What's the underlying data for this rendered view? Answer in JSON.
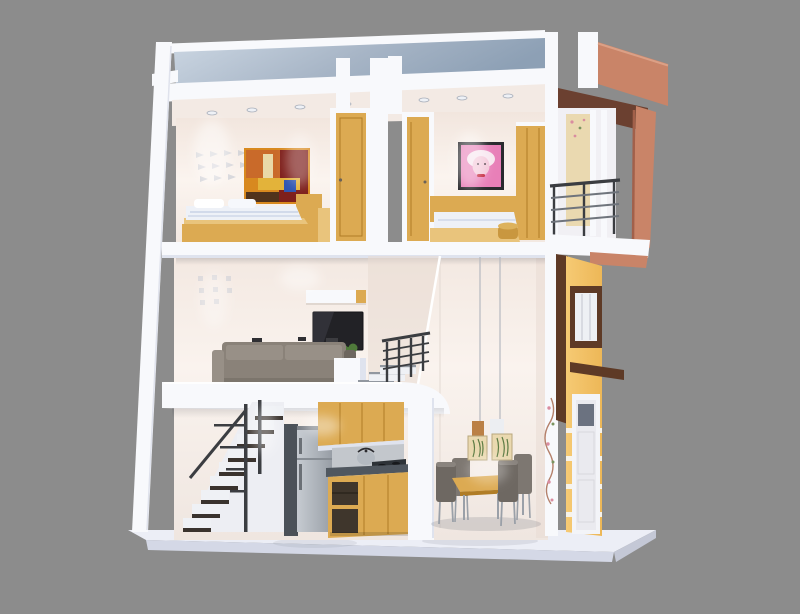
{
  "scene": {
    "type": "3d-architectural-cutaway-render",
    "description": "Dollhouse cross-section of a narrow three-level townhouse on a gray studio background",
    "background": "#8c8c8c"
  },
  "house": {
    "floors": [
      {
        "name": "roof-terrace",
        "items": [
          "white-parapet",
          "blue-gray-roof-deck",
          "terracotta-roof-box"
        ]
      },
      {
        "name": "upper-floor",
        "rooms": [
          {
            "name": "bedroom-left",
            "items": [
              "wall-decal",
              "abstract-painting",
              "wood-bed",
              "white-bedding",
              "wood-headboard",
              "wood-door"
            ]
          },
          {
            "name": "bedroom-right",
            "items": [
              "wood-door",
              "pop-art-portrait",
              "wood-bed",
              "gold-pouf",
              "wood-wardrobe"
            ]
          },
          {
            "name": "balcony",
            "items": [
              "cream-curtain-panel",
              "white-mullions",
              "metal-railing",
              "terracotta-frame"
            ]
          }
        ]
      },
      {
        "name": "mezzanine-floor",
        "rooms": [
          {
            "name": "living-room",
            "items": [
              "wall-decal",
              "wall-shelf",
              "wall-mounted-tv",
              "potted-plant",
              "white-side-table",
              "gray-sofa",
              "stair-railing",
              "steps-to-upper"
            ]
          }
        ]
      },
      {
        "name": "ground-floor",
        "rooms": [
          {
            "name": "staircase",
            "items": [
              "dark-tread-stairs",
              "metal-railing"
            ]
          },
          {
            "name": "kitchen",
            "items": [
              "refrigerator",
              "upper-wood-cabinets",
              "kettle",
              "cooktop",
              "dark-countertop",
              "lower-wood-cabinets"
            ]
          },
          {
            "name": "dining-area",
            "items": [
              "pendant-lamps-fern-shades",
              "wood-dining-table",
              "four-gray-chairs",
              "vine-wall-decor"
            ]
          },
          {
            "name": "street-facade",
            "items": [
              "yellow-wall",
              "brown-framed-window",
              "brown-sill",
              "white-entry-door",
              "white-grooves"
            ]
          }
        ]
      }
    ],
    "base": "white-display-plinth"
  },
  "colors": {
    "bg": "#8c8c8c",
    "slab": "#f8f9fc",
    "slabShade": "#dfe3ee",
    "slabDeep": "#c9cdda",
    "wall": "#f6ece5",
    "wallLight": "#fbf5f0",
    "wallShade": "#e7dad2",
    "wallCool": "#f1f0f4",
    "ceil": "#f3eae4",
    "roofLight": "#ccd7e3",
    "roofDark": "#8da0b5",
    "wood": "#dcaa52",
    "woodDark": "#b07c25",
    "woodLight": "#e9c47c",
    "terracotta": "#c98468",
    "terracottaDark": "#a2604a",
    "brownUnder": "#6b4030",
    "brownFrame": "#5e3a26",
    "facade": "#f3c46d",
    "facadeBand": "#f7f3ea",
    "sofa": "#8a8279",
    "sofaLight": "#989087",
    "sofaDark": "#6e675f",
    "tv": "#222226",
    "tvGloss": "#3c3c44",
    "steel": "#b4bac1",
    "steelDark": "#8d939b",
    "applianceSide": "#4b5158",
    "counter": "#50575f",
    "stove": "#2e3338",
    "tread": "#3a332e",
    "rail": "#3b3d41",
    "riser": "#eff1f5",
    "bedding": "#eef1f7",
    "beddingShade": "#c9d3e6",
    "gold": "#c9973f",
    "chair": "#6e6862",
    "chairLight": "#7d7771",
    "chairLeg": "#9aa0a8",
    "plant": "#4f7a3a",
    "pot": "#eceef2",
    "artOrange": "#c96a2a",
    "artRed": "#7e201c",
    "artYellow": "#e3b33a",
    "artBlue": "#2e55b0",
    "artDark": "#50331c",
    "artBase": "#d8891f",
    "popFrame": "#2a2a2e",
    "popPink": "#e87fb8",
    "popSkin": "#f3c6d8",
    "popHair": "#f7e6ef",
    "popLips": "#c0182f",
    "decal": "#c9ccd4",
    "shadeCream": "#ead9b0",
    "fern": "#5d7c44",
    "cord": "#b6b9c0",
    "base": "#eceef6",
    "baseEdge": "#d4d8e6",
    "baseSide": "#c4c8d6",
    "doorWhite": "#f3f4f8",
    "doorPane": "#6b7280",
    "vinePink": "#d98ca0",
    "vineGreen": "#7a9460",
    "vineStem": "#b4806a",
    "glassWhite": "#eef0f4",
    "mullion": "#c9ccd4",
    "chairLegHex": "#9aa0a8",
    "shadow": "#5a5e6a"
  }
}
